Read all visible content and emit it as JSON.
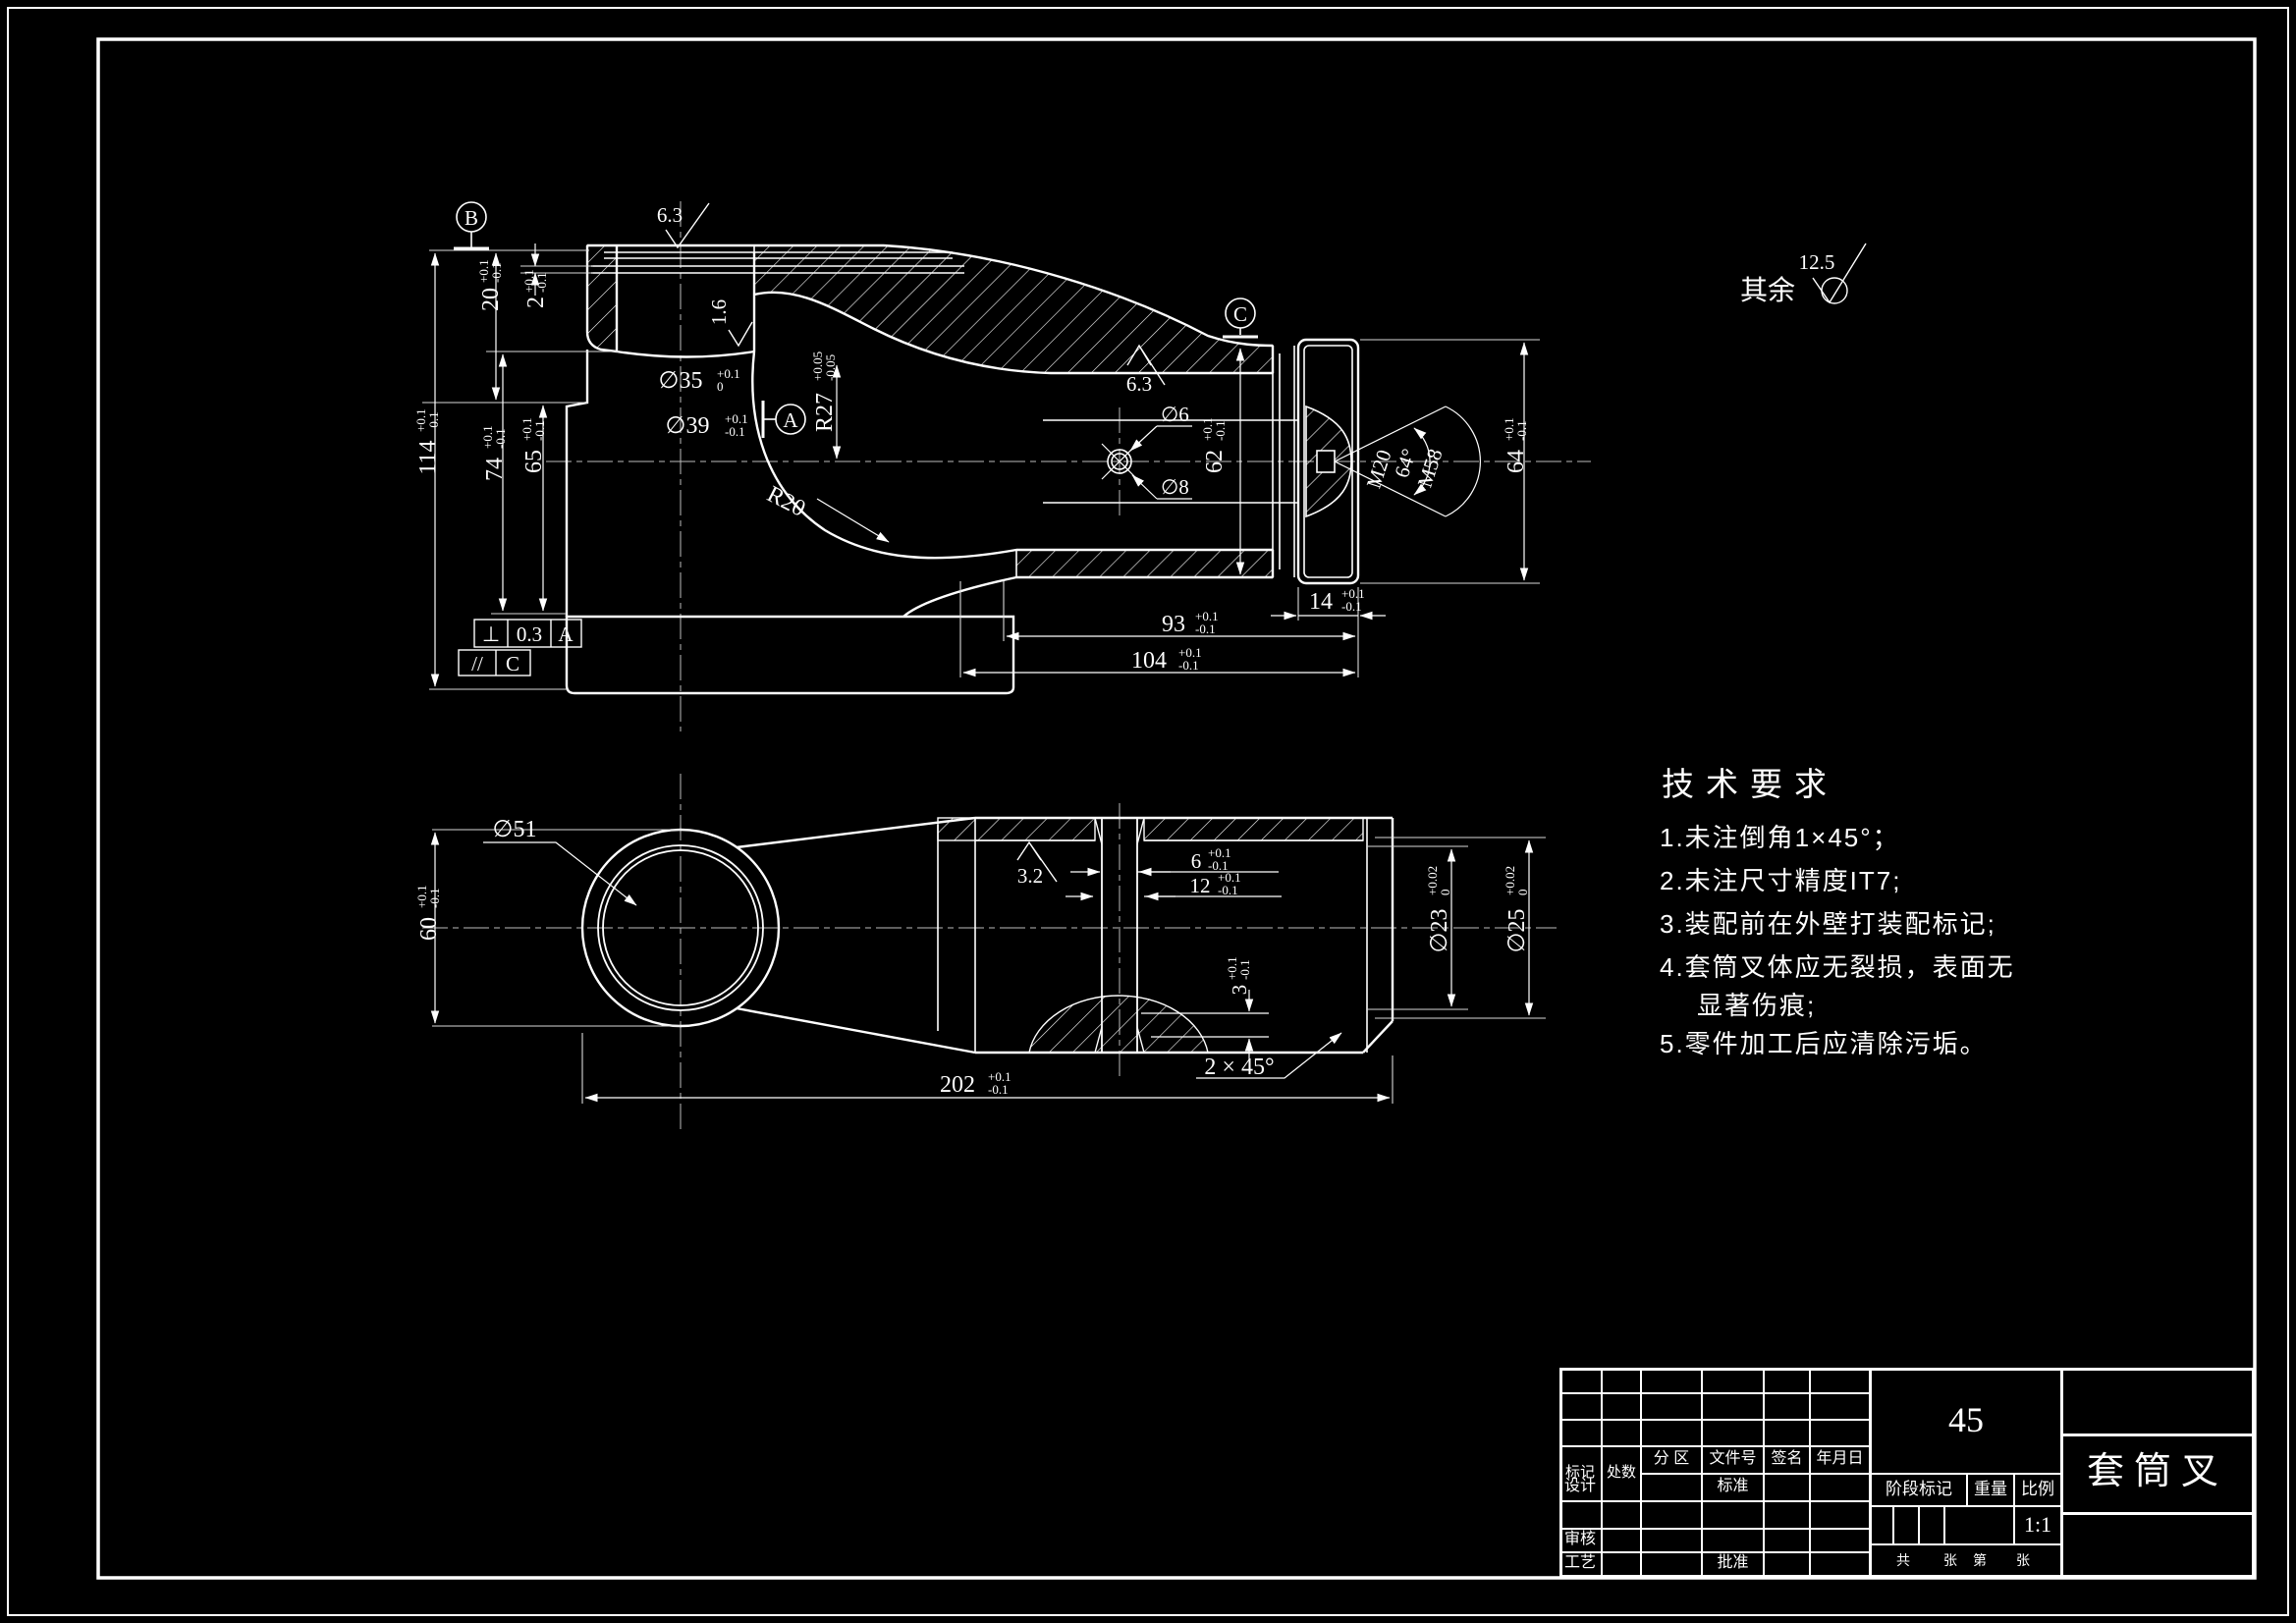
{
  "colors": {
    "background": "#000000",
    "line": "#ffffff"
  },
  "sheet": {
    "default_roughness_label": "其余",
    "default_roughness_value": "12.5"
  },
  "datums": {
    "A": "A",
    "B": "B",
    "C": "C"
  },
  "fcf": {
    "perp_sym": "⊥",
    "perp_val": "0.3",
    "perp_datum": "A",
    "par_sym": "//",
    "par_datum": "C"
  },
  "dims": {
    "d20": {
      "v": "20",
      "tp": "+0.1",
      "tm": "-0.1"
    },
    "d2": {
      "v": "2",
      "tp": "+0.1",
      "tm": "-0.1"
    },
    "r16": "1.6",
    "d35": {
      "v": "∅35",
      "tp": "+0.1",
      "tm": "0"
    },
    "d39": {
      "v": "∅39",
      "tp": "+0.1",
      "tm": "-0.1"
    },
    "r27": {
      "v": "R27",
      "tp": "+0.05",
      "tm": "-0.05"
    },
    "r20": "R20",
    "d114": {
      "v": "114",
      "tp": "+0.1",
      "tm": "-0.1"
    },
    "d74": {
      "v": "74",
      "tp": "+0.1",
      "tm": "-0.1"
    },
    "d65": {
      "v": "65",
      "tp": "+0.1",
      "tm": "-0.1"
    },
    "r63a": "6.3",
    "r63b": "6.3",
    "d6hole": "∅6",
    "d8hole": "∅8",
    "d62": {
      "v": "62",
      "tp": "+0.1",
      "tm": "-0.1"
    },
    "m20": "M20",
    "a64": "64°",
    "m58": "M58",
    "d64": {
      "v": "64",
      "tp": "+0.1",
      "tm": "-0.1"
    },
    "d14": {
      "v": "14",
      "tp": "+0.1",
      "tm": "-0.1"
    },
    "d93": {
      "v": "93",
      "tp": "+0.1",
      "tm": "-0.1"
    },
    "d104": {
      "v": "104",
      "tp": "+0.1",
      "tm": "-0.1"
    },
    "d51": "∅51",
    "d60": {
      "v": "60",
      "tp": "+0.1",
      "tm": "-0.1"
    },
    "r32": "3.2",
    "d6slot": {
      "v": "6",
      "tp": "+0.1",
      "tm": "-0.1"
    },
    "d12slot": {
      "v": "12",
      "tp": "+0.1",
      "tm": "-0.1"
    },
    "d23": {
      "v": "∅23",
      "tp": "+0.02",
      "tm": "0"
    },
    "d25": {
      "v": "∅25",
      "tp": "+0.02",
      "tm": "0"
    },
    "d3": {
      "v": "3",
      "tp": "+0.1",
      "tm": "-0.1"
    },
    "d202": {
      "v": "202",
      "tp": "+0.1",
      "tm": "-0.1"
    },
    "chamfer": "2 × 45°"
  },
  "tech": {
    "title": "技术要求",
    "lines": [
      "1.未注倒角1×45°；",
      "2.未注尺寸精度IT7;",
      "3.装配前在外壁打装配标记;",
      "4.套筒叉体应无裂损，表面无",
      "显著伤痕;",
      "5.零件加工后应清除污垢。"
    ]
  },
  "title_block": {
    "material": "45",
    "part_name": "套筒叉",
    "scale_value": "1:1",
    "mark": "标记",
    "count": "处数",
    "zone": "分 区",
    "file_no": "文件号",
    "signature": "签名",
    "date": "年月日",
    "design": "设计",
    "standard": "标准",
    "check": "审核",
    "process": "工艺",
    "approve": "批准",
    "stage_mark": "阶段标记",
    "weight": "重量",
    "scale": "比例",
    "total": "共",
    "sheets": "张",
    "page": "第",
    "sheets2": "张"
  }
}
